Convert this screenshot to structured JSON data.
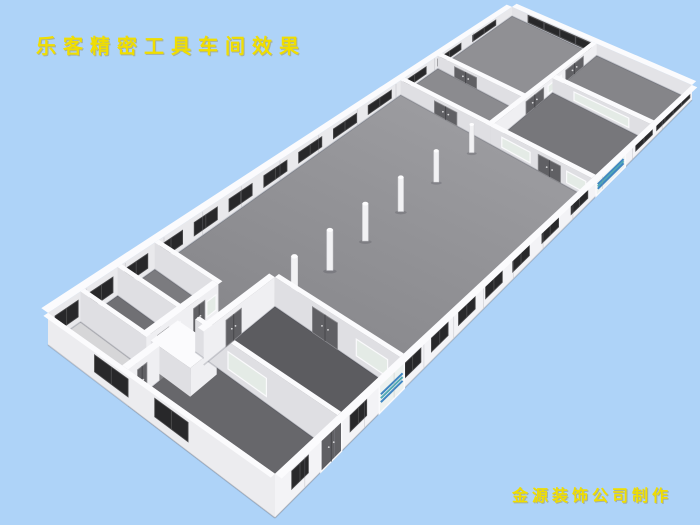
{
  "title": {
    "text": "乐客精密工具车间效果"
  },
  "credit": {
    "text": "金源装饰公司制作"
  },
  "colors": {
    "background": "#aed3f8",
    "text_yellow": "#f0de00",
    "wall_top": "#fbfbfd",
    "wall_inner_nw": "#e9e9ec",
    "wall_inner_ne": "#e3e3e7",
    "wall_face_se": "#efeff2",
    "wall_face_sw": "#dfdfe3",
    "wall_outer_se": "#f3f3f6",
    "wall_outer_sw": "#ececef",
    "hall_floor_light": "#a4a4a8",
    "hall_floor_dark": "#7c7c80",
    "floor_bathroom": "#d6d6d8",
    "floor_room_a": "#707074",
    "floor_room_b": "#7b7b7f",
    "floor_room_c": "#67676b",
    "floor_room_d": "#5c5c60",
    "floor_room_e": "#8b8b8f",
    "floor_room_f": "#909094",
    "floor_room_g": "#77777b",
    "floor_room_h": "#858589",
    "window_dark": "#28282a",
    "window_frame": "#4b4b4d",
    "door_gray": "#606064",
    "door_split": "#47474b",
    "door_handle": "#d9d9db",
    "frosted_glass": "#e4ebe6",
    "frosted_frame": "#fafafc",
    "shutter_base": "#edf2f0",
    "shutter_stripe_blue": "#3f86c2",
    "shutter_stripe_teal": "#52aab4",
    "column_white": "#f2f2f4",
    "column_shade": "#d7d7db",
    "wall_base_shadow": "rgba(40,45,60,0.18)",
    "seam": "rgba(150,150,158,0.35)",
    "fixture_white": "#f8f8fa",
    "fixture_edge": "#c9c9cd"
  }
}
